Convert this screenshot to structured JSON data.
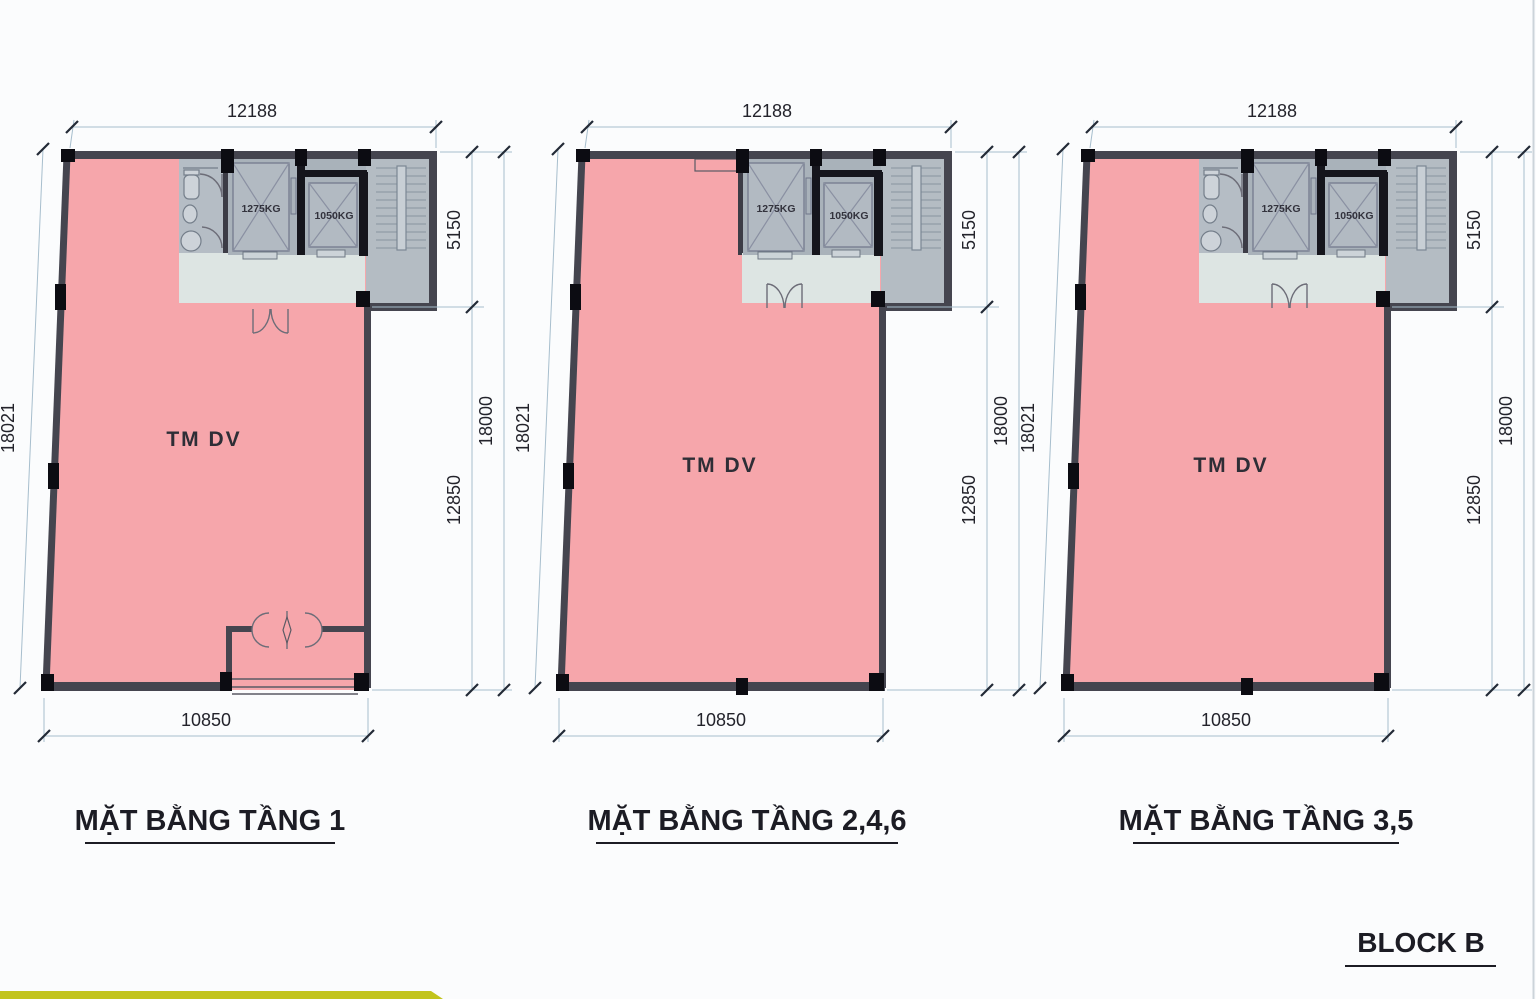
{
  "sheet": {
    "block_label": "BLOCK B",
    "background_color": "#fbfcfd",
    "accent_bar_color": "#c2c41d"
  },
  "palette": {
    "room_fill": "#f6a6ab",
    "wall": "#45454f",
    "column": "#0c0c12",
    "elevator_hall_fill": "#a9b2ba",
    "wc_fill": "#b5bdc5",
    "lobby_fill": "#dde5e3",
    "stair_fill": "#b4bcc3",
    "dimension_line": "#a7becd",
    "dimension_text": "#23232b",
    "title_text": "#1c1c24"
  },
  "core": {
    "elevator1_label": "1275KG",
    "elevator2_label": "1050KG"
  },
  "plans": [
    {
      "title": "MẶT BẰNG TẦNG 1",
      "room_label": "TM DV",
      "dims": {
        "top": "12188",
        "left": "18021",
        "right_upper": "5150",
        "right_lower": "12850",
        "right_total": "18000",
        "bottom": "10850"
      }
    },
    {
      "title": "MẶT BẰNG TẦNG 2,4,6",
      "room_label": "TM DV",
      "dims": {
        "top": "12188",
        "left": "18021",
        "right_upper": "5150",
        "right_lower": "12850",
        "right_total": "18000",
        "bottom": "10850"
      }
    },
    {
      "title": "MẶT BẰNG TẦNG 3,5",
      "room_label": "TM DV",
      "dims": {
        "top": "12188",
        "left": "18021",
        "right_upper": "5150",
        "right_lower": "12850",
        "right_total": "18000",
        "bottom": "10850"
      }
    }
  ]
}
